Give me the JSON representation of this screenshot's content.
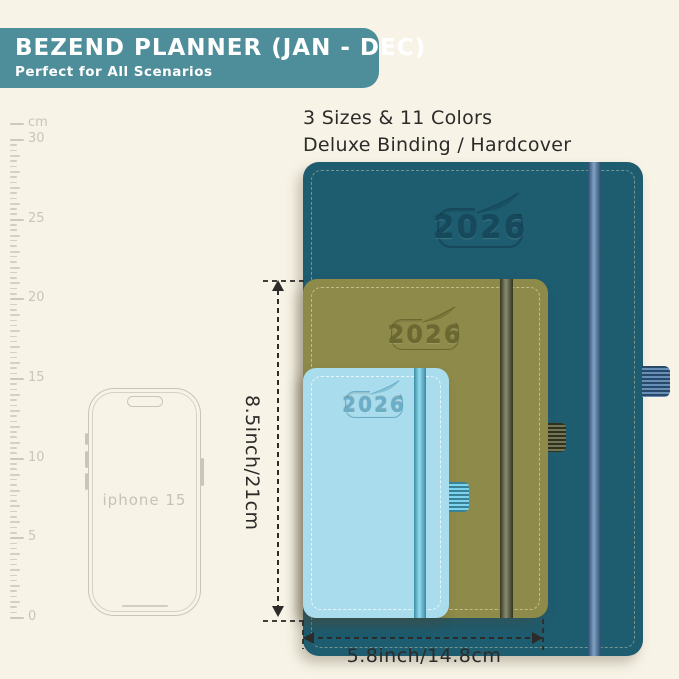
{
  "banner": {
    "title": "BEZEND PLANNER (JAN - DEC)",
    "subtitle": "Perfect for All Scenarios",
    "bg": "#4e8e9a",
    "text_color": "#ffffff"
  },
  "features": {
    "line1": "3 Sizes & 11 Colors",
    "line2": "Deluxe Binding / Hardcover"
  },
  "ruler": {
    "unit": "cm",
    "max_cm": 30,
    "label_step_cm": 5,
    "tick_labels": [
      "0",
      "5",
      "10",
      "15",
      "20",
      "25",
      "30"
    ],
    "px_per_cm": 15.93,
    "minor_ticks_per_cm": 3
  },
  "phone": {
    "label": "iphone 15"
  },
  "planners": [
    {
      "name": "large-teal",
      "year": "2026",
      "cover": "#1e5c70",
      "band": "#3e70a2",
      "stitch": "rgba(224,219,183,0.5)",
      "deboss": "#15495b"
    },
    {
      "name": "medium-olive",
      "year": "2026",
      "cover": "#8e8a49",
      "band": "#4a4e28",
      "stitch": "rgba(248,243,205,0.55)",
      "deboss": "#6b6830"
    },
    {
      "name": "small-blue",
      "year": "2026",
      "cover": "#a9dcec",
      "band": "#57c8e9",
      "stitch": "rgba(255,255,255,0.8)",
      "deboss": "#6aaec8"
    }
  ],
  "dimensions": {
    "height_label": "8.5inch/21cm",
    "width_label": "5.8inch/14.8cm"
  },
  "colors": {
    "background": "#f7f3e6",
    "annotation": "#2c2b29",
    "ruler": "#d4d0c3",
    "phone_outline": "#c9c5b8"
  }
}
